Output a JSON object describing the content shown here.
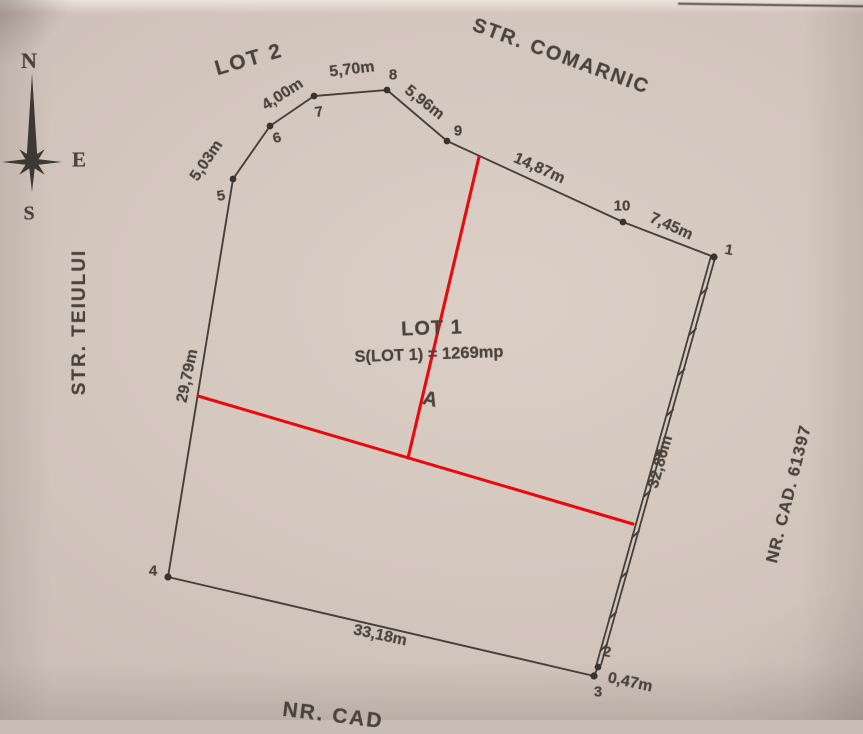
{
  "compass": {
    "north": "N",
    "east": "E",
    "south": "S"
  },
  "labels": {
    "lot2": "LOT 2",
    "street_top": "STR. COMARNIC",
    "street_left": "STR. TEIULUI",
    "cad_right": "NR. CAD. 61397",
    "cad_bottom": "NR. CAD",
    "lot1_title": "LOT 1",
    "lot1_area": "S(LOT 1) = 1269mp",
    "divider_marker": "A"
  },
  "vertices": [
    {
      "label": "1"
    },
    {
      "label": "2"
    },
    {
      "label": "3"
    },
    {
      "label": "4"
    },
    {
      "label": "5"
    },
    {
      "label": "6"
    },
    {
      "label": "7"
    },
    {
      "label": "8"
    },
    {
      "label": "9"
    },
    {
      "label": "10"
    }
  ],
  "measurements": [
    {
      "edge": "5-6",
      "label": "5,03m"
    },
    {
      "edge": "6-7",
      "label": "4,00m"
    },
    {
      "edge": "7-8",
      "label": "5,70m"
    },
    {
      "edge": "8-9",
      "label": "5,96m"
    },
    {
      "edge": "9-10",
      "label": "14,87m"
    },
    {
      "edge": "10-1",
      "label": "7,45m"
    },
    {
      "edge": "1-2",
      "label": "32,86m"
    },
    {
      "edge": "2-3",
      "label": "0,47m"
    },
    {
      "edge": "3-4",
      "label": "33,18m"
    },
    {
      "edge": "4-5",
      "label": "29,79m"
    }
  ],
  "colors": {
    "paper": "#d3c6bd",
    "ink": "#473f39",
    "red": "#e90a10"
  }
}
